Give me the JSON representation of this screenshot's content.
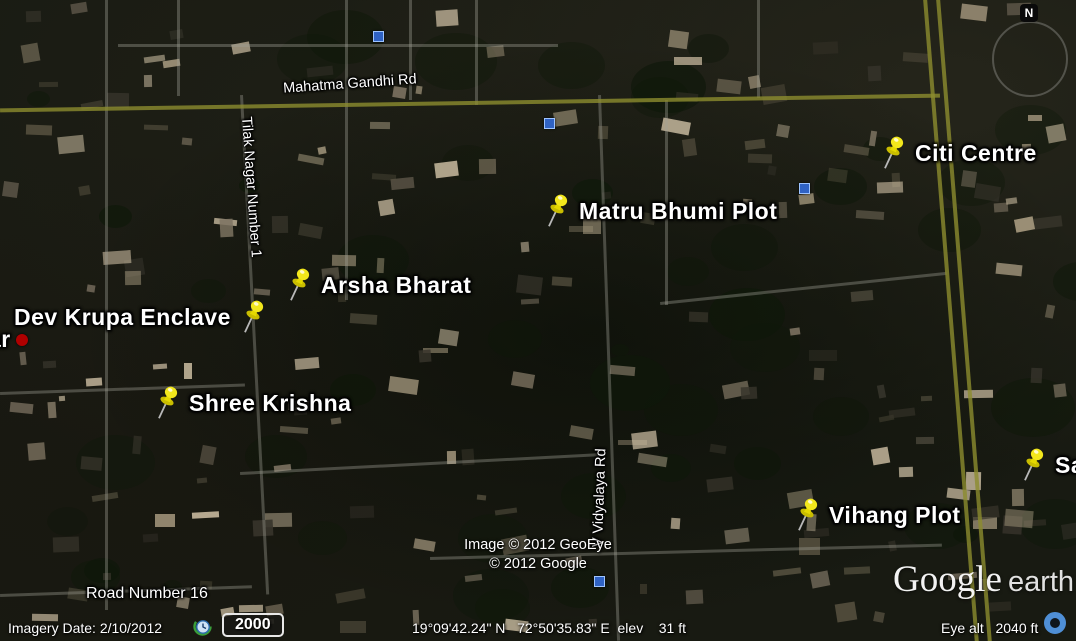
{
  "map": {
    "placemarks": [
      {
        "label": "Dev Krupa Enclave"
      },
      {
        "label": "Arsha Bharat"
      },
      {
        "label": "Shree Krishna"
      },
      {
        "label": "Matru Bhumi Plot"
      },
      {
        "label": "Citi Centre"
      },
      {
        "label": "Vihang Plot"
      },
      {
        "label": "Sa"
      },
      {
        "label": "ar"
      }
    ],
    "road_labels": [
      {
        "label": "Mahatma Gandhi Rd"
      },
      {
        "label": "Tilak Nagar Number 1"
      },
      {
        "label": "V Vidyalaya Rd"
      },
      {
        "label": "Road Number 16"
      }
    ],
    "copyright_line1": "Image © 2012 GeoEye",
    "copyright_line2": "© 2012 Google",
    "logo_google": "Google",
    "logo_earth": "earth",
    "compass_letter": "N"
  },
  "status_bar": {
    "imagery_date": "Imagery Date: 2/10/2012",
    "time_value": "2000",
    "coordinates": "19°09'42.24\" N   72°50'35.83\" E  elev    31 ft",
    "eye_alt": "Eye alt   2040 ft"
  },
  "colors": {
    "pushpin_yellow": "#f2e71c",
    "road_overlay_olive": "#8c8c2e",
    "label_text": "#ffffff",
    "red_dot": "#b00000",
    "photo_icon_blue": "#2f62c4",
    "stream_icon_blue": "#4f8fd6",
    "clock_icon_green": "#3a9e3a"
  }
}
